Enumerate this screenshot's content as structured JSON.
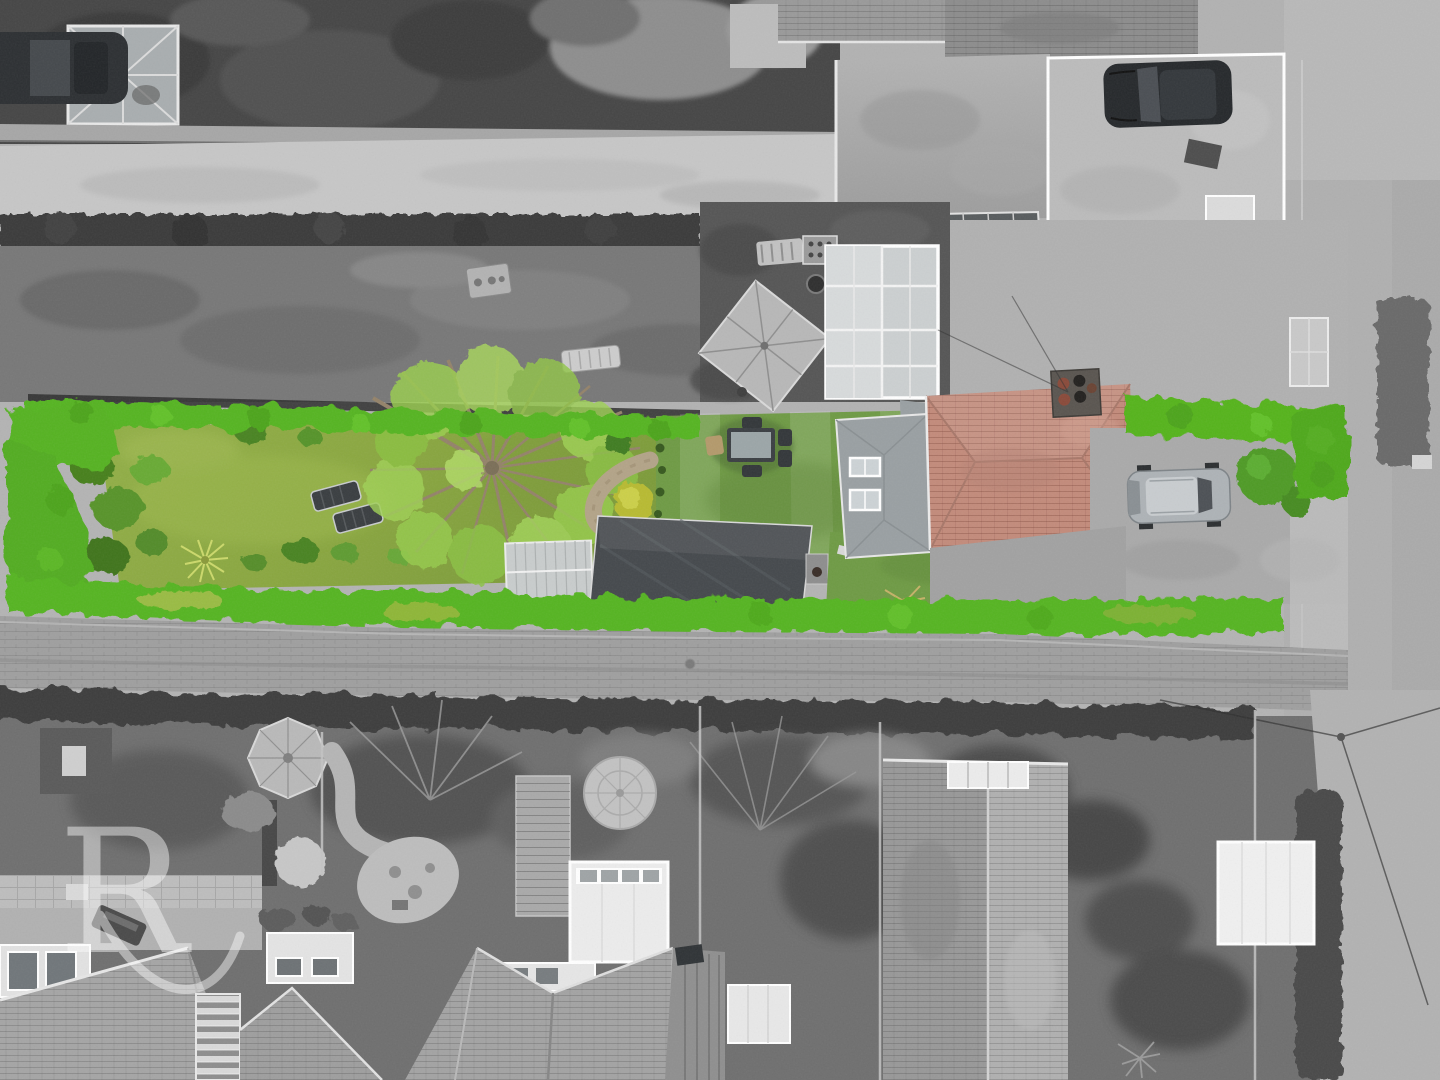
{
  "image": {
    "kind": "aerial-drone-photograph",
    "style": "selective-colour: subject plot saturated, surroundings desaturated to grayscale",
    "subject": "long narrow rear garden and house plot viewed from directly above"
  },
  "watermark": {
    "letter": "R"
  },
  "palette": {
    "hedge_green": "#57b522",
    "hedge_green_dark": "#49a01b",
    "lawn_green": "#8caa44",
    "artificial_lawn_green": "#6f9b45",
    "tree_foliage_green": "#9acb4f",
    "shrub_dark_green": "#4e8a28",
    "yellow_shrub": "#b8bb33",
    "roof_terracotta": "#c38b7b",
    "shed_charcoal": "#45494d",
    "greenhouse_gray": "#c9cdcd",
    "paving_gray": "#9f9f9f",
    "driveway_gray": "#bcbcbc",
    "road_gray": "#b0b0b0",
    "vegetation_dark_gray": "#3d3d3d",
    "car_silver": "#aeb3b7",
    "car_black": "#26292c",
    "bin_brown": "#7a5b40",
    "bin_gray_green": "#6e7d62",
    "bin_teal": "#3e7d6e",
    "watermark_white": "#ffffff"
  },
  "objects": {
    "in_colour": [
      "boundary hedges",
      "main lawn",
      "mature tree",
      "two sun loungers",
      "shrub border with palm",
      "curved stone path",
      "topiary bush",
      "yellow shrub",
      "artificial lawn",
      "outdoor dining set",
      "small greenhouse",
      "large garden shed",
      "rear lawn",
      "three wheelie bins",
      "ornamental grass",
      "terracotta tiled roof with chimney",
      "grey extension roof with two rooflights",
      "silver parked car",
      "ball shrub"
    ],
    "desaturated": [
      "neighbouring gardens",
      "gravel track and fences",
      "neighbour patio with square parasol",
      "white conservatory roof",
      "black parked car on driveway",
      "street and verges",
      "rear alleyway",
      "terraced house roofs",
      "octagonal parasol",
      "stone circle patio",
      "decking",
      "white flat-roof extensions",
      "power lines"
    ]
  }
}
